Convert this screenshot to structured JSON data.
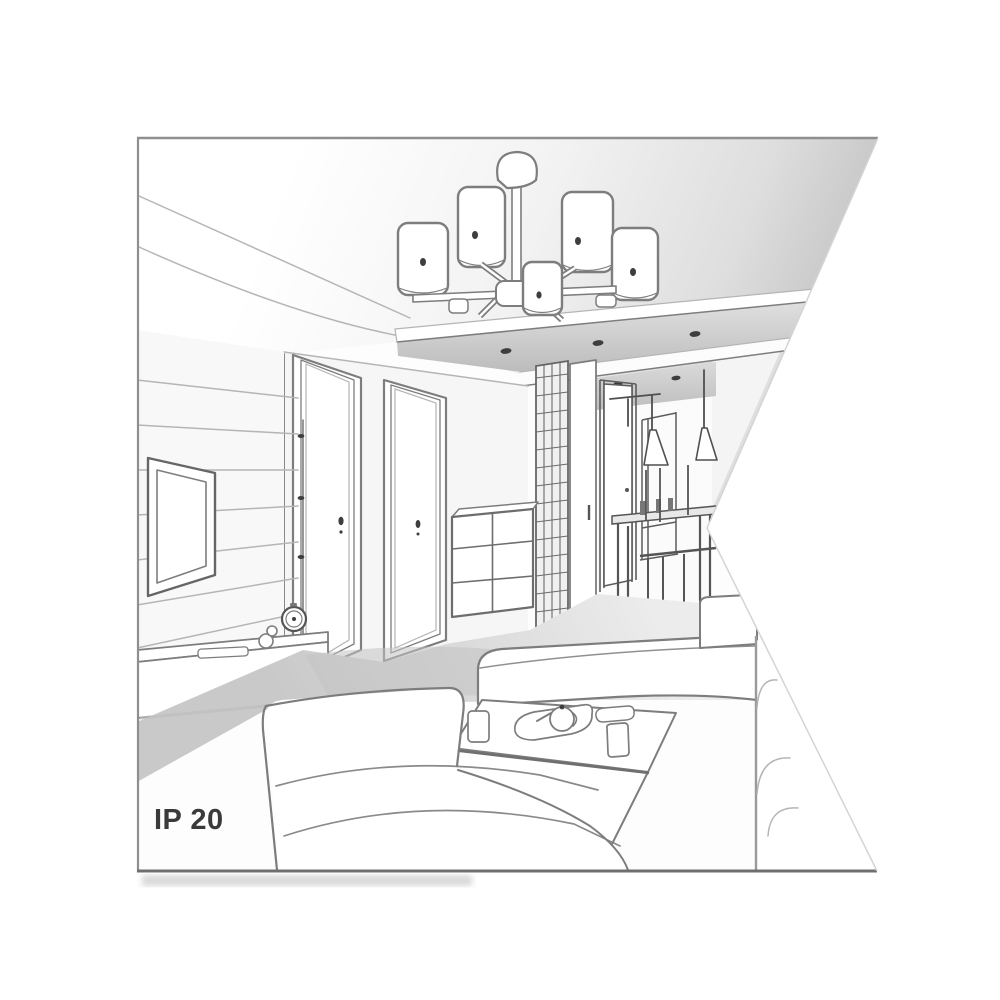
{
  "illustration": {
    "label": "IP 20",
    "colors": {
      "background": "#ffffff",
      "text": "#3a3a3a",
      "line": "#7d7d7d",
      "line_dark": "#4f4f4f",
      "line_light": "#b5b5b5",
      "border": "#8f8f8f",
      "ceiling_shade": "#c6c6c6",
      "floor_shade": "#c9c9c9",
      "spot_dark": "#3e3e3e"
    },
    "elements": [
      "six-shade-ceiling-chandelier",
      "suspended-ceiling-panel",
      "recessed-spotlights",
      "tv-wall",
      "tv-stand-with-clock",
      "two-interior-doors",
      "drawer-cabinet",
      "lattice-wardrobe",
      "hallway-with-pendant-lamps",
      "dining-table-and-chairs",
      "sofa",
      "ottoman",
      "coffee-table-with-tea-set"
    ]
  }
}
